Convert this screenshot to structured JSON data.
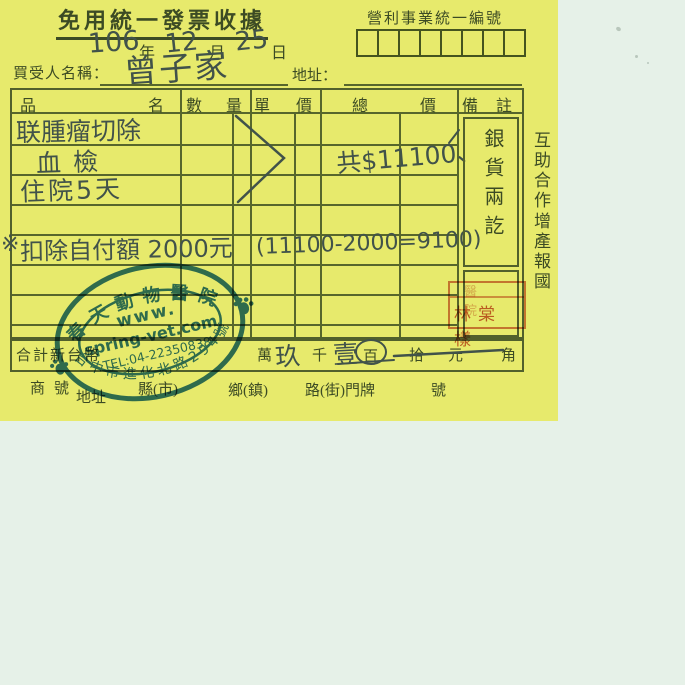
{
  "colors": {
    "paper_yellow": "#e7ea6c",
    "scanner_background": "#e6f1e8",
    "printed_ink_green": "#3c4b24",
    "grid_line_olive": "#57662c",
    "handwriting_ink": "#41524a",
    "stamp_blue": "#2268ae",
    "seal_red": "#c6482c"
  },
  "receipt": {
    "title": "免用統一發票收據",
    "date": {
      "year": "106",
      "year_unit": "年",
      "month": "12",
      "month_unit": "月",
      "day": "25",
      "day_unit": "日"
    },
    "tax_id_label": "營利事業統一編號",
    "buyer_label": "買受人名稱：",
    "buyer_name": "曾子家",
    "address_label": "地址：",
    "table": {
      "headers": {
        "item_l": "品",
        "item_r": "名",
        "qty_l": "數",
        "qty_r": "量",
        "unit_l": "單",
        "unit_r": "價",
        "total_l": "總",
        "total_r": "價",
        "note_l": "備",
        "note_r": "註"
      },
      "items": {
        "row1": "联腫瘤切除",
        "row2": "血檢",
        "row3": "住院5天"
      },
      "amount": "共$11100、",
      "note_mark": "※",
      "note_text": "扣除自付額 2000元",
      "note_calc": "(11100-2000=9100)",
      "remark_stamp": "銀貨兩訖"
    },
    "slogan": {
      "line1": "互助合作",
      "line2": "增產報國"
    },
    "total_row": {
      "label": "合計新台幣",
      "wan": "萬",
      "digit_thousands": "玖",
      "qian": "千",
      "digit_hundreds": "壹",
      "bai": "百",
      "shi": "拾",
      "yuan": "元",
      "jiao": "角"
    },
    "footer": {
      "shop": "商",
      "shop_suffix": "號",
      "address": "地址",
      "county": "縣(市)",
      "township": "鄉(鎮)",
      "road": "路(街)門牌",
      "number": "號"
    },
    "vet_stamp": {
      "name": "春天動物醫院",
      "web_prefix": "www.",
      "web_domain": "spring-vet.com",
      "phone": "TEL:04-22350838",
      "address": "台中市進化北路294號"
    },
    "red_seal": {
      "top": "醫院",
      "name": "林棠樣"
    }
  }
}
